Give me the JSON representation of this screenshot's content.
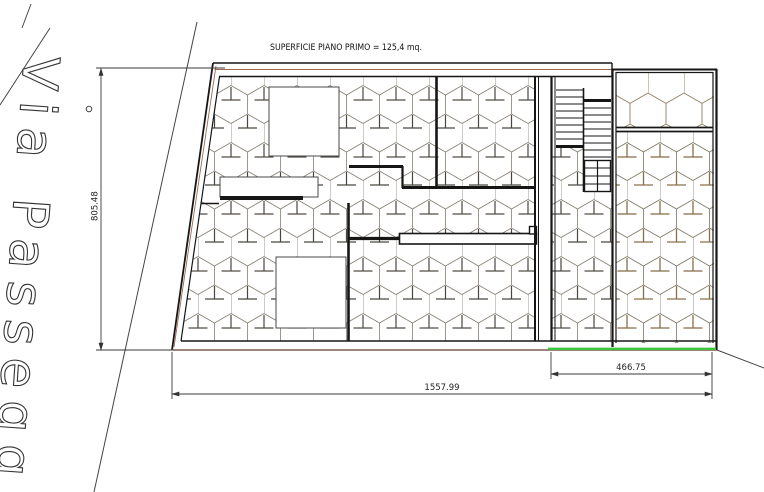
{
  "header": {
    "title": "SUPERFICIE PIANO PRIMO = 125,4 mq."
  },
  "street": {
    "name": "Via Passegg"
  },
  "dimensions": {
    "left_height": "805.48",
    "bottom_total": "1557.99",
    "bottom_right": "466.75"
  },
  "colors": {
    "wall": "#161616",
    "hatch": "#857f72",
    "hatch_stem": "#4a463e",
    "hatch_brown": "#7d7665",
    "hatch_brown_stem": "#8a6f4c",
    "hatch_light": "#8d7d5e",
    "accent_brown": "#9b6b55",
    "ground_brown": "#7a5c4e",
    "green_line": "#3dc53d",
    "dim": "#3a3a3a",
    "road": "#444444"
  }
}
